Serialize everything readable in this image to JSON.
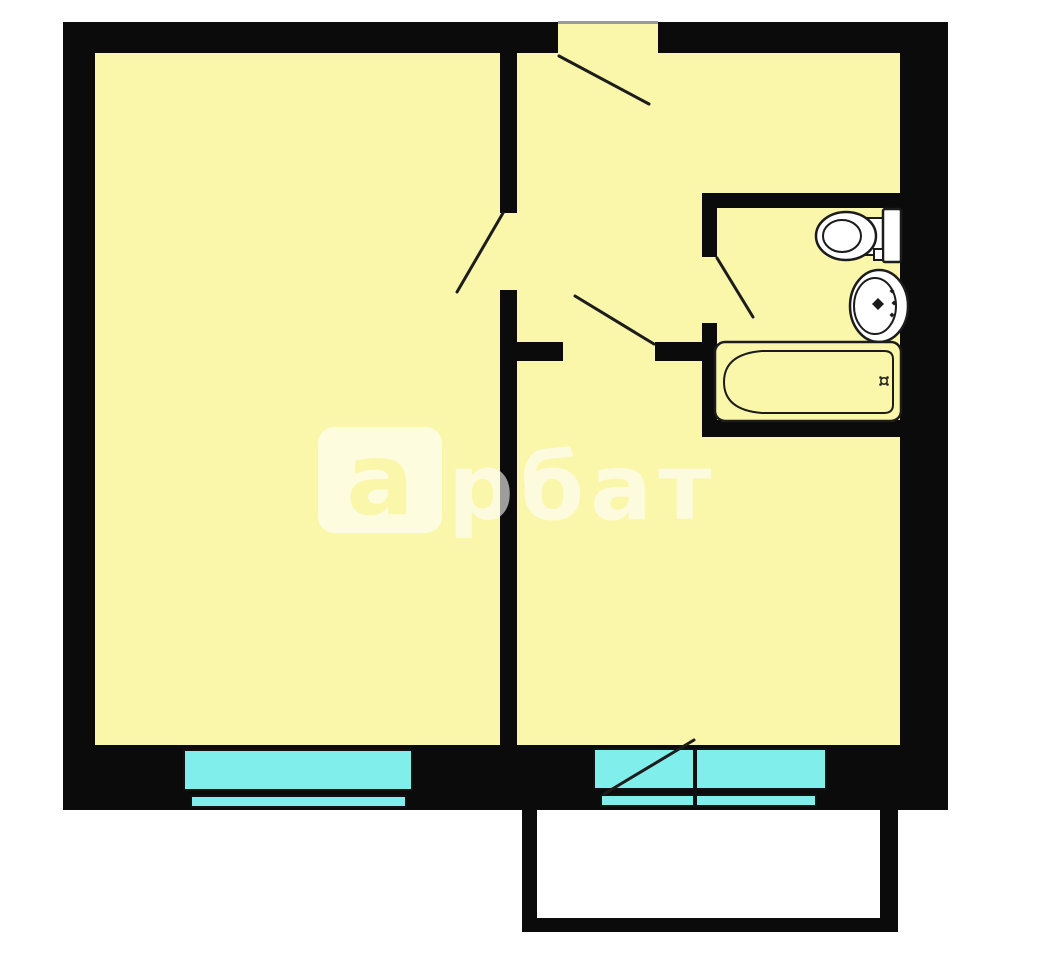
{
  "watermark": {
    "brand": "арбат",
    "logo_letter": "а",
    "text_after_logo": "рбат"
  },
  "colors": {
    "background": "#ffffff",
    "wall": "#0b0b0b",
    "room_fill": "#faf6aa",
    "window_glass": "#80eeea",
    "fixture_fill": "#ffffff",
    "line": "#1c1c1c",
    "watermark_text": "rgba(255,255,255,0.6)",
    "watermark_logo_bg": "rgba(255,255,255,0.62)"
  },
  "plan": {
    "type": "apartment-floor-plan",
    "rooms": [
      {
        "name": "room-left"
      },
      {
        "name": "hallway"
      },
      {
        "name": "bathroom"
      },
      {
        "name": "room-right"
      },
      {
        "name": "balcony"
      }
    ],
    "fixtures": [
      {
        "name": "toilet"
      },
      {
        "name": "sink"
      },
      {
        "name": "bathtub"
      }
    ],
    "windows": [
      {
        "name": "window-left"
      },
      {
        "name": "window-right-with-balcony-door"
      }
    ],
    "doors": [
      {
        "name": "entrance-door"
      },
      {
        "name": "room-left-door"
      },
      {
        "name": "room-right-door"
      },
      {
        "name": "bathroom-door"
      },
      {
        "name": "balcony-door"
      }
    ]
  }
}
